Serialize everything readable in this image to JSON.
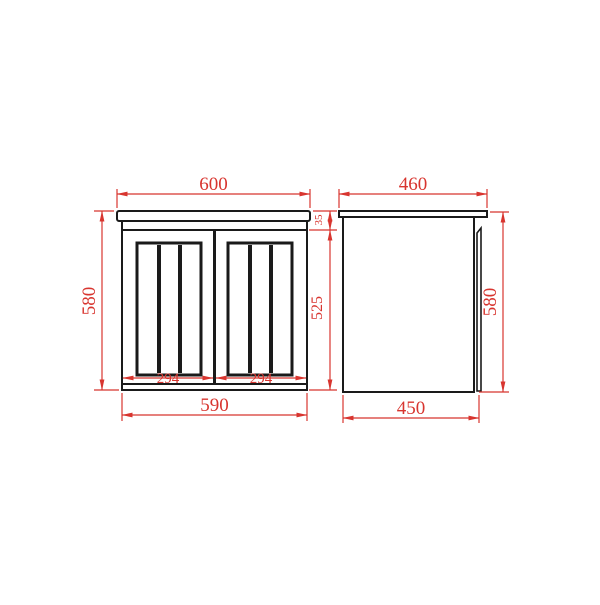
{
  "drawing": {
    "front_view": {
      "labels": {
        "top_width": "600",
        "overall_height": "580",
        "door_height": "525",
        "top_thickness": "35",
        "left_door_width": "294",
        "right_door_width": "294",
        "bottom_width": "590"
      }
    },
    "side_view": {
      "labels": {
        "top_depth": "460",
        "overall_height": "580",
        "bottom_depth": "450"
      }
    },
    "colors": {
      "dimension_red": "#d8352f",
      "object_line_black": "#1a1a1a",
      "background": "#ffffff"
    }
  }
}
